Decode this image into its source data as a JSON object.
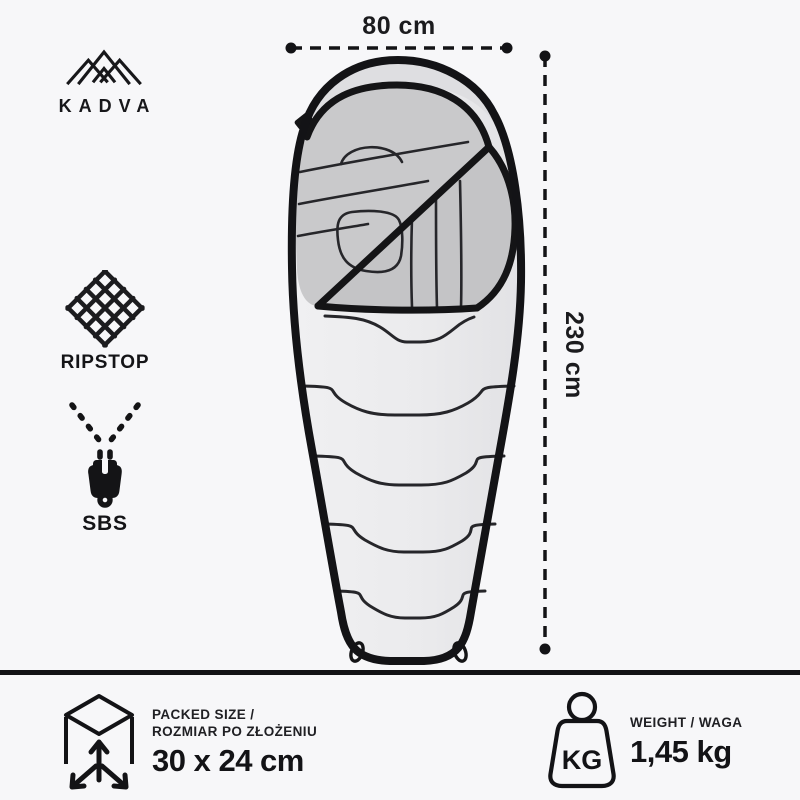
{
  "brand": {
    "name": "KADVA",
    "icon": "mountain-logo-icon"
  },
  "dimensions": {
    "width": {
      "label": "80 cm"
    },
    "length": {
      "label": "230 cm"
    }
  },
  "features": {
    "ripstop": {
      "label": "RIPSTOP",
      "icon": "ripstop-fabric-icon"
    },
    "zipper": {
      "label": "SBS",
      "icon": "sbs-zipper-icon"
    }
  },
  "specs": {
    "packed_size": {
      "title_line1": "PACKED SIZE /",
      "title_line2": "ROZMIAR PO ZŁOŻENIU",
      "value": "30 x 24 cm",
      "icon": "packed-cube-icon"
    },
    "weight": {
      "title": "WEIGHT / WAGA",
      "value": "1,45 kg",
      "unit": "KG",
      "icon": "kg-weight-icon"
    }
  },
  "colors": {
    "ink": "#141416",
    "background": "#f7f7f9",
    "bag_shell": "#ececee",
    "hood_lining": "#c9c9cb",
    "flap_lining": "#c4c4c6"
  }
}
